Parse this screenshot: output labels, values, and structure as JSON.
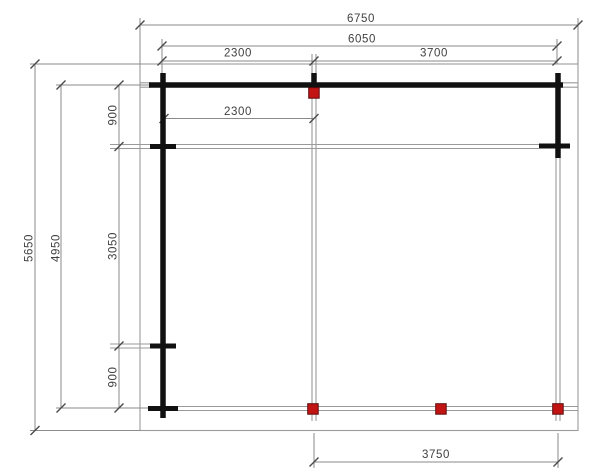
{
  "colors": {
    "background": "#ffffff",
    "outline": "#9a9a9a",
    "wall": "#111111",
    "dimension_line": "#8a8a8a",
    "tick": "#4a4a4a",
    "label_text": "#3f3f3f",
    "post_fill": "#c31414",
    "post_stroke": "#5f0909"
  },
  "dimensions": {
    "top": {
      "overall_width": "6750",
      "frame_width": "6050",
      "left_bay": "2300",
      "right_bay": "3700"
    },
    "interior": {
      "partition_length": "2300"
    },
    "left": {
      "overall_depth": "5650",
      "frame_depth": "4950",
      "top_bay": "900",
      "middle_bay": "3050",
      "bottom_bay": "900"
    },
    "bottom": {
      "front_opening": "3750"
    }
  }
}
